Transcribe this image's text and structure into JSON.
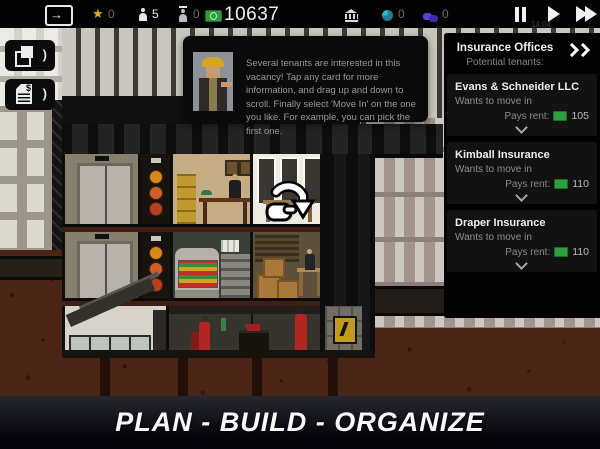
{
  "top_bar": {
    "star_count": "0",
    "workers_count": "5",
    "visitors_count": "0",
    "cash": "10637",
    "influence_count": "0",
    "deals_count": "0",
    "clock": "14:04"
  },
  "icons": {
    "star": "★",
    "exit_arrow": "→",
    "chevron": ")",
    "dollar": "$"
  },
  "tutorial": {
    "text": "Several tenants are interested in this vacancy! Tap any card for more information, and drag up and down to scroll. Finally select 'Move In' on the one you like. For example, you can pick the first one."
  },
  "tenant_panel": {
    "title": "Insurance Offices",
    "subtitle": "Potential tenants:",
    "cards": [
      {
        "name": "Evans & Schneider LLC",
        "status": "Wants to move in",
        "rent_label": "Pays rent:",
        "rent": "105"
      },
      {
        "name": "Kimball Insurance",
        "status": "Wants to move in",
        "rent_label": "Pays rent:",
        "rent": "110"
      },
      {
        "name": "Draper Insurance",
        "status": "Wants to move in",
        "rent_label": "Pays rent:",
        "rent": "110"
      }
    ]
  },
  "banner": {
    "text": "PLAN - BUILD - ORGANIZE"
  },
  "colors": {
    "accent_money": "#2f9e3f",
    "star_yellow": "#e0b21e",
    "influence_teal": "#35b9c9",
    "deals_purple": "#5a3fd8",
    "dirt_brown": "#4a2414"
  }
}
